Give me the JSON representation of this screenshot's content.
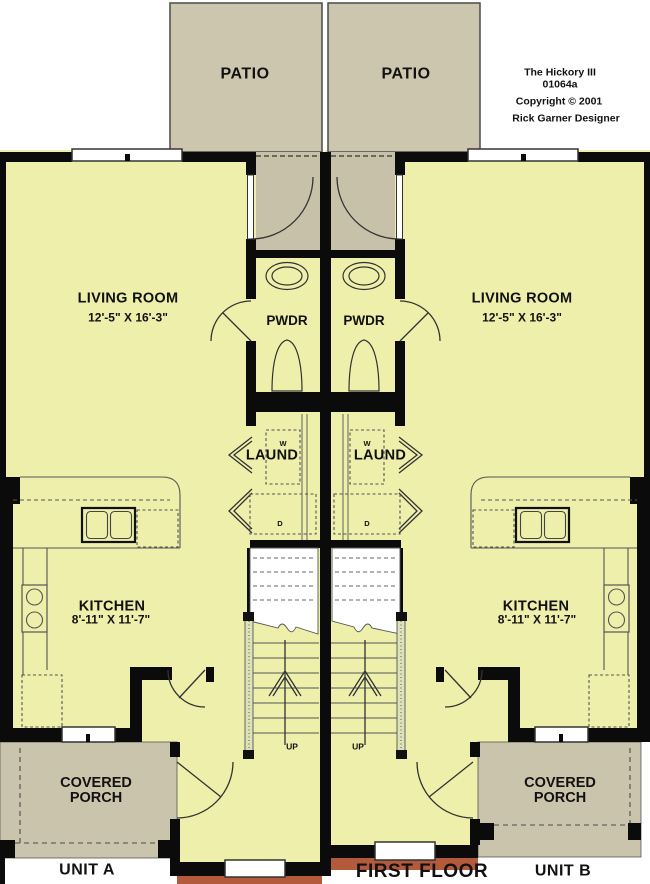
{
  "plan": {
    "title": "The Hickory III",
    "number": "01064a",
    "copyright": "Copyright ©  2001",
    "designer": "Rick Garner Designer",
    "floor_label": "FIRST FLOOR"
  },
  "units": {
    "a": {
      "label": "UNIT A"
    },
    "b": {
      "label": "UNIT B"
    }
  },
  "rooms": {
    "patio": {
      "label": "PATIO"
    },
    "living_room": {
      "label": "LIVING ROOM",
      "dimensions": "12'-5\" X 16'-3\""
    },
    "powder_room": {
      "label": "PWDR"
    },
    "laundry": {
      "label": "LAUND",
      "washer": "W",
      "dryer": "D"
    },
    "kitchen": {
      "label": "KITCHEN",
      "dimensions": "8'-11\" X 11'-7\""
    },
    "stairs": {
      "label": "UP"
    },
    "covered_porch": {
      "label": "COVERED PORCH"
    }
  },
  "colors": {
    "floor": "#edefab",
    "patio": "#cdc6af",
    "porch": "#cbc4ac",
    "vestibule": "#c8c1a9",
    "wall": "#0b0b0b",
    "brick": "#b3593c",
    "line": "#555555"
  }
}
